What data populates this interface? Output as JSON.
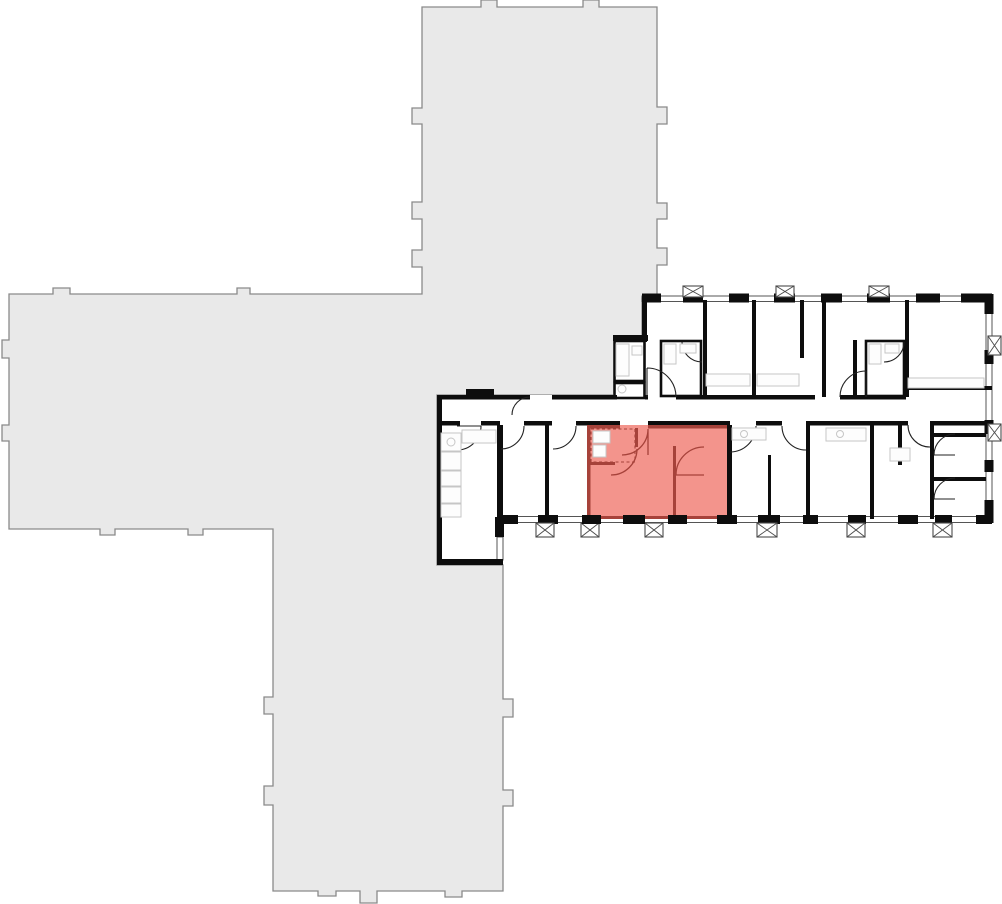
{
  "scene": {
    "kind": "building-floorplan",
    "description_visible": "",
    "highlighted_units": 1
  },
  "colors": {
    "background": "#ffffff",
    "building_fill": "#e9e9e9",
    "building_outline": "#8a8a8a",
    "wall": "#0d0d0d",
    "window_wall": "#555555",
    "door": "#222222",
    "fixture": "#c6c6c6",
    "shaft": "#4a4a4a",
    "unit_fill": "#f3948c",
    "unit_wall": "#a6423a"
  }
}
